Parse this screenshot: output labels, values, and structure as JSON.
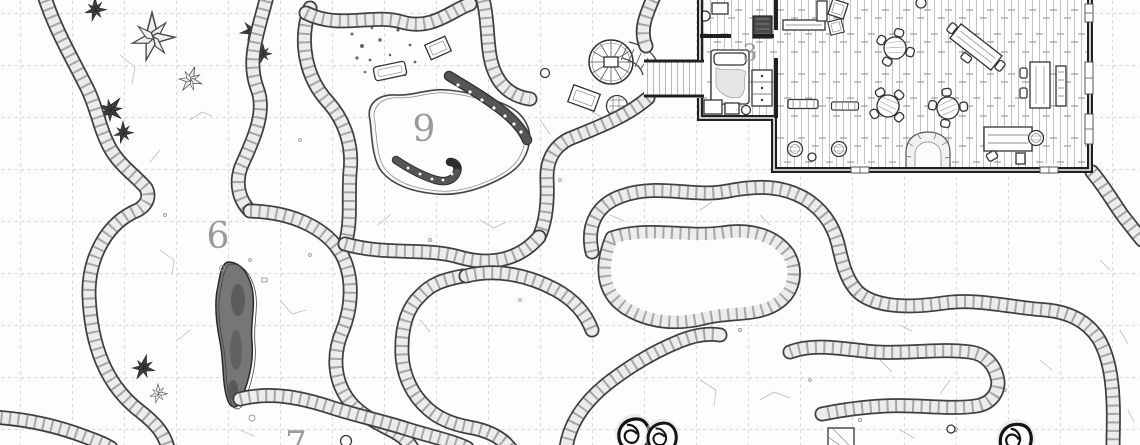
{
  "map": {
    "title": "cave-and-tavern dungeon battle map",
    "style": "hand-drawn black-and-white ink on white with square grid",
    "grid": {
      "cell_px": 52,
      "line_color": "#d8d8d8",
      "line_style": "dashed"
    },
    "palette": {
      "background": "#fdfdfd",
      "grid_line": "#d8d8d8",
      "wall_outline": "#3f3f3f",
      "wall_fill": "#ececec",
      "building_wall": "#202020",
      "furniture_ink": "#333333",
      "room_label": "#9a9a9a",
      "chasm_fill": "#767676",
      "tentacle": "#4a4a4a",
      "crystal_dark": "#3e3e3e",
      "egg_outline": "#141414"
    },
    "room_labels": [
      {
        "number": "9",
        "area": "flooded pool cave with tentacled creature"
      },
      {
        "number": "6",
        "area": "cavern with dark chasm"
      },
      {
        "number": "7",
        "area": "cavern at bottom edge, label partly cut off"
      },
      {
        "number": "3",
        "area": "tavern bedroom"
      }
    ],
    "cave_features": [
      {
        "name": "crystal-clusters",
        "location": "north-west cavern walls"
      },
      {
        "name": "tentacle-pool",
        "location": "room 9",
        "details": "two dark suckered tentacles rising from an irregular pool"
      },
      {
        "name": "dark-chasm",
        "location": "room 6"
      },
      {
        "name": "debris-scatter",
        "location": "alcove north of the pool"
      },
      {
        "name": "crate-and-bedroll",
        "location": "alcove north of the pool"
      },
      {
        "name": "spiral-staircase",
        "location": "east chamber, joined to the tavern by a wooden walkway"
      },
      {
        "name": "crate-and-woven-basket",
        "location": "below the spiral staircase"
      },
      {
        "name": "spiral-shell-eggs",
        "count": 3,
        "location": "bottom caverns"
      },
      {
        "name": "hatched-crate",
        "location": "bottom-right cavern"
      },
      {
        "name": "narrow-winding-corridors",
        "details": "one-square-wide rocky passages linking the caverns"
      }
    ],
    "tavern": {
      "walls": "thick black timber",
      "floor": "vertical wood planks",
      "windows": 5,
      "walkway": "plank bridge from tavern door to spiral staircase",
      "rooms": [
        {
          "label": "3",
          "name": "bedroom",
          "furniture": [
            "bed with pillow and blanket",
            "dresser",
            "side table",
            "chest",
            "stool"
          ]
        },
        {
          "name": "storeroom",
          "furniture": [
            "stool",
            "crate",
            "dark wardrobe"
          ]
        },
        {
          "name": "common-hall",
          "furniture": [
            "bar counter",
            "round table with chairs x3",
            "tilted long table",
            "rectangular table with side bench",
            "plank table",
            "bench x2",
            "barrel x3",
            "stone hearth",
            "tilted crate x2",
            "stool x2"
          ]
        }
      ]
    }
  }
}
